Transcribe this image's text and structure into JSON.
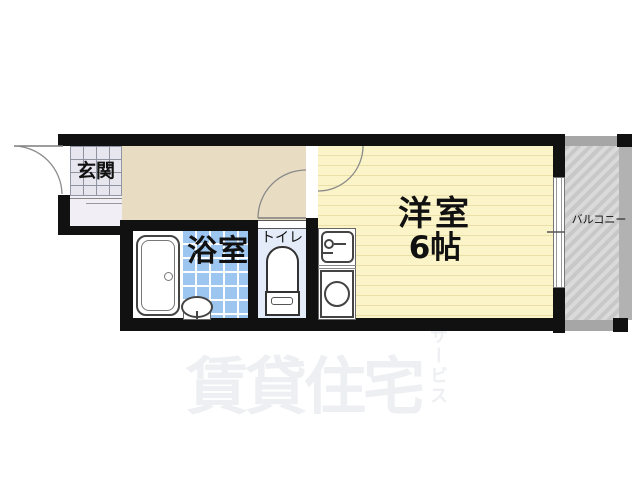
{
  "floor_plan": {
    "rooms": {
      "entrance": {
        "label": "玄関"
      },
      "bathroom": {
        "label": "浴室"
      },
      "toilet": {
        "label": "トイレ"
      },
      "main_room": {
        "label": "洋室",
        "size_label": "6帖"
      },
      "balcony": {
        "label": "バルコニー"
      }
    },
    "fixtures": [
      "bathtub",
      "washbasin",
      "toilet-bowl",
      "kitchen-sink",
      "stove-burner"
    ],
    "watermark": {
      "main": "賃貸住宅",
      "sub": "サービス"
    },
    "colors": {
      "wall": "#111111",
      "hallway_floor": "#e8ddc2",
      "main_room_floor": "#fbf4c8",
      "main_room_stripe": "#eadfa6",
      "bath_tile": "#9cc5ef",
      "toilet_floor": "#e4ecf9",
      "entrance_tile": "#e7e5ed",
      "balcony_gray": "#c8c8c8",
      "watermark_gray": "#edeff2"
    }
  }
}
